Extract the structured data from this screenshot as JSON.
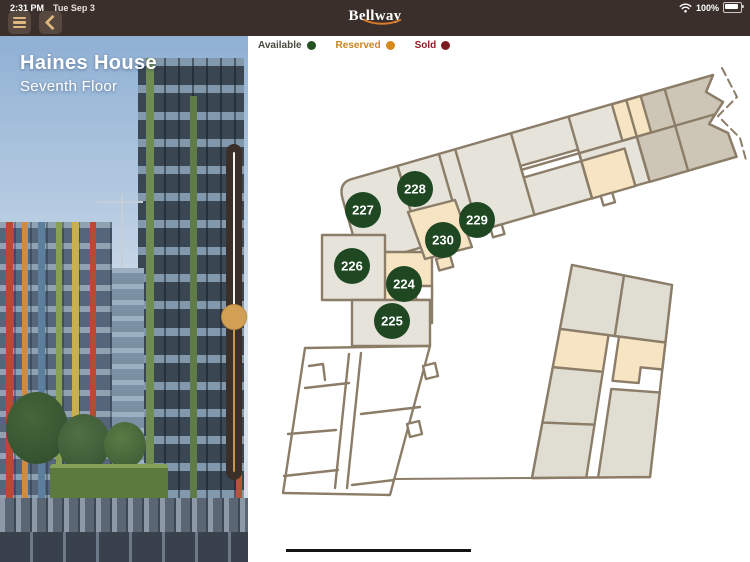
{
  "status_bar": {
    "time": "2:31 PM",
    "date": "Tue Sep 3",
    "battery_percent": "100%"
  },
  "header": {
    "app_name": "Bellway",
    "accent_color": "#d97a28"
  },
  "building_panel": {
    "title": "Haines House",
    "subtitle": "Seventh Floor"
  },
  "legend": {
    "items": [
      {
        "label": "Available",
        "dot_color": "#265223",
        "text_color": "#4a4a40"
      },
      {
        "label": "Reserved",
        "dot_color": "#d6891f",
        "text_color": "#c9851f"
      },
      {
        "label": "Sold",
        "dot_color": "#7c1b20",
        "text_color": "#8c2025"
      }
    ]
  },
  "floorplan": {
    "status_colors": {
      "available": "#1e4722",
      "reserved": "#d6891f",
      "sold": "#7c1b20"
    },
    "units": [
      {
        "number": "227",
        "status": "available",
        "x": 115,
        "y": 174
      },
      {
        "number": "228",
        "status": "available",
        "x": 167,
        "y": 153
      },
      {
        "number": "229",
        "status": "available",
        "x": 229,
        "y": 184
      },
      {
        "number": "230",
        "status": "available",
        "x": 195,
        "y": 204
      },
      {
        "number": "226",
        "status": "available",
        "x": 104,
        "y": 230
      },
      {
        "number": "224",
        "status": "available",
        "x": 156,
        "y": 248
      },
      {
        "number": "225",
        "status": "available",
        "x": 144,
        "y": 285
      }
    ]
  }
}
